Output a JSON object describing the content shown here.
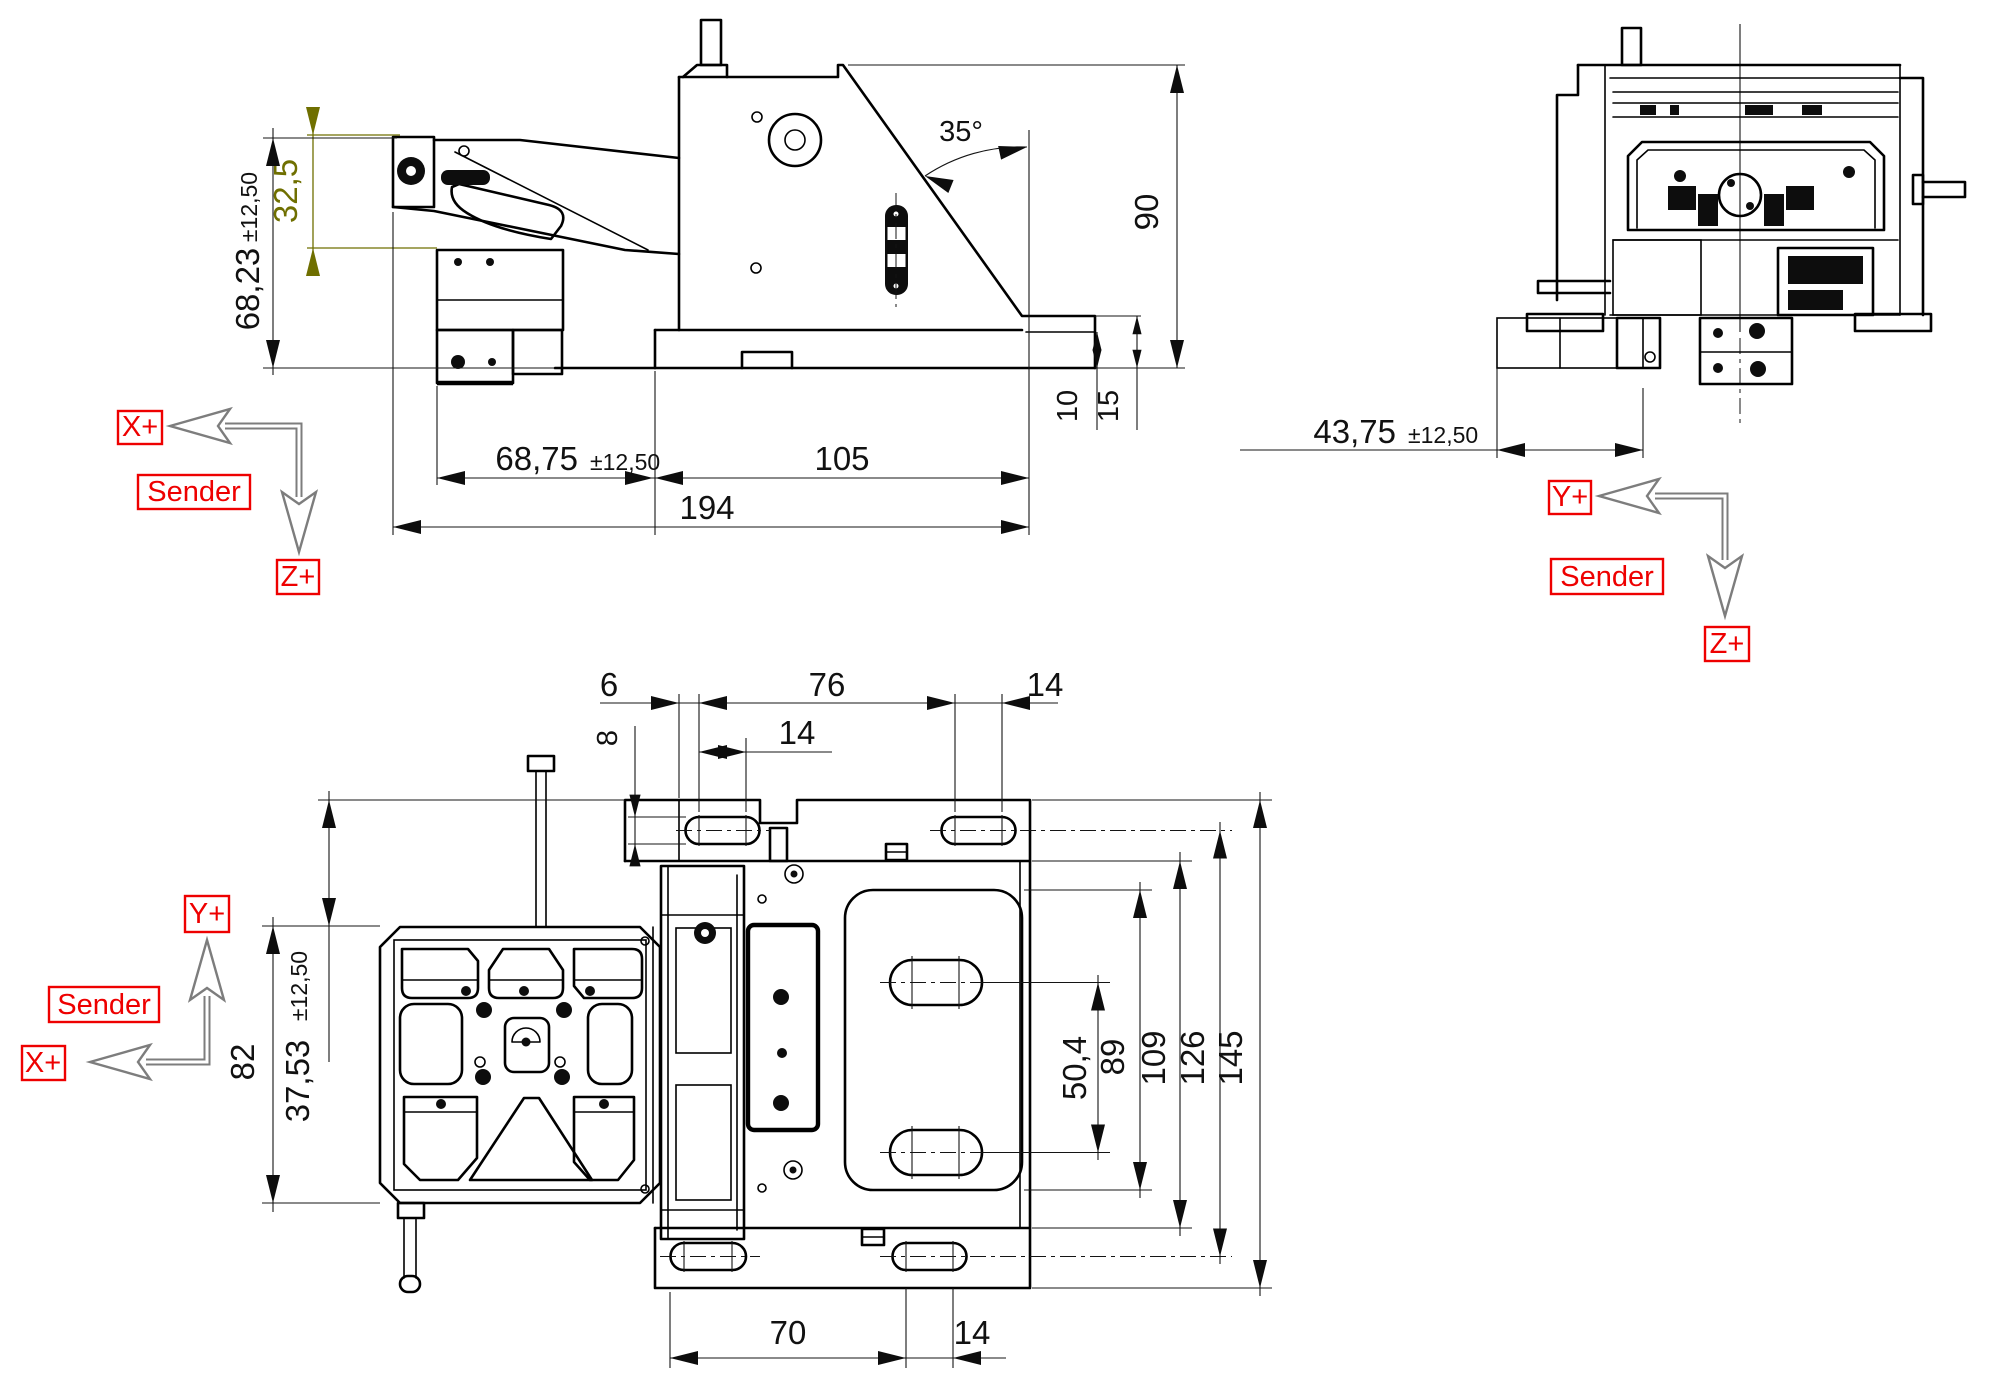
{
  "side_view": {
    "dims": {
      "arm_height": "32,5",
      "ref_height": "68,23",
      "ref_height_tol": "±12,50",
      "angle": "35°",
      "total_height": "90",
      "step_10": "10",
      "step_15": "15",
      "offset_x": "68,75",
      "offset_x_tol": "±12,50",
      "body_length": "105",
      "total_length": "194"
    },
    "axes": {
      "x": "X+",
      "z": "Z+",
      "sender": "Sender"
    }
  },
  "front_view": {
    "dims": {
      "offset_y": "43,75",
      "offset_y_tol": "±12,50"
    },
    "axes": {
      "y": "Y+",
      "z": "Z+",
      "sender": "Sender"
    }
  },
  "top_view": {
    "dims": {
      "edge_6": "6",
      "slot_span_76": "76",
      "slot_len_14_right": "14",
      "slot_len_14_inner": "14",
      "slot_width_8": "8",
      "offset_37_53": "37,53",
      "offset_37_53_tol": "±12,50",
      "head_height_82": "82",
      "inner_slots_50_4": "50,4",
      "pocket_89": "89",
      "body_109": "109",
      "slot_lines_126": "126",
      "total_145": "145",
      "bottom_70": "70",
      "bottom_14": "14"
    },
    "axes": {
      "y": "Y+",
      "x": "X+",
      "sender": "Sender"
    }
  },
  "colors": {
    "background": "#ffffff",
    "part_line": "#000000",
    "dimension_line": "#141414",
    "highlight_dimension": "#6f6f00",
    "axis_arrow": "#7d7d7d",
    "axis_label": "#ee0000"
  }
}
